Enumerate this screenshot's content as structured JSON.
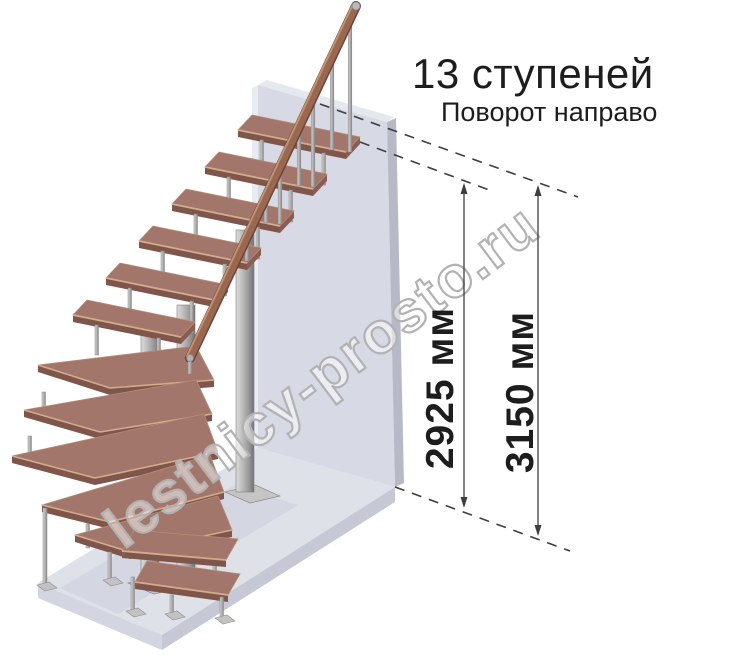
{
  "header": {
    "title": "13 ступеней",
    "subtitle": "Поворот направо"
  },
  "dimensions": {
    "height_to_top_step": "2925 мм",
    "total_height": "3150 мм"
  },
  "watermark": "lestnicy-prosto.ru",
  "illustration": {
    "kind": "3d-staircase-render",
    "steps_count": "13",
    "turn": "направо",
    "colors": {
      "tread_wood": "#a3766c",
      "rail_wood": "#9a6850",
      "metal": "#b6b6b6",
      "wall": "#d7dae4",
      "floor": "#dfe1e9",
      "line": "#3e3e3e"
    }
  }
}
